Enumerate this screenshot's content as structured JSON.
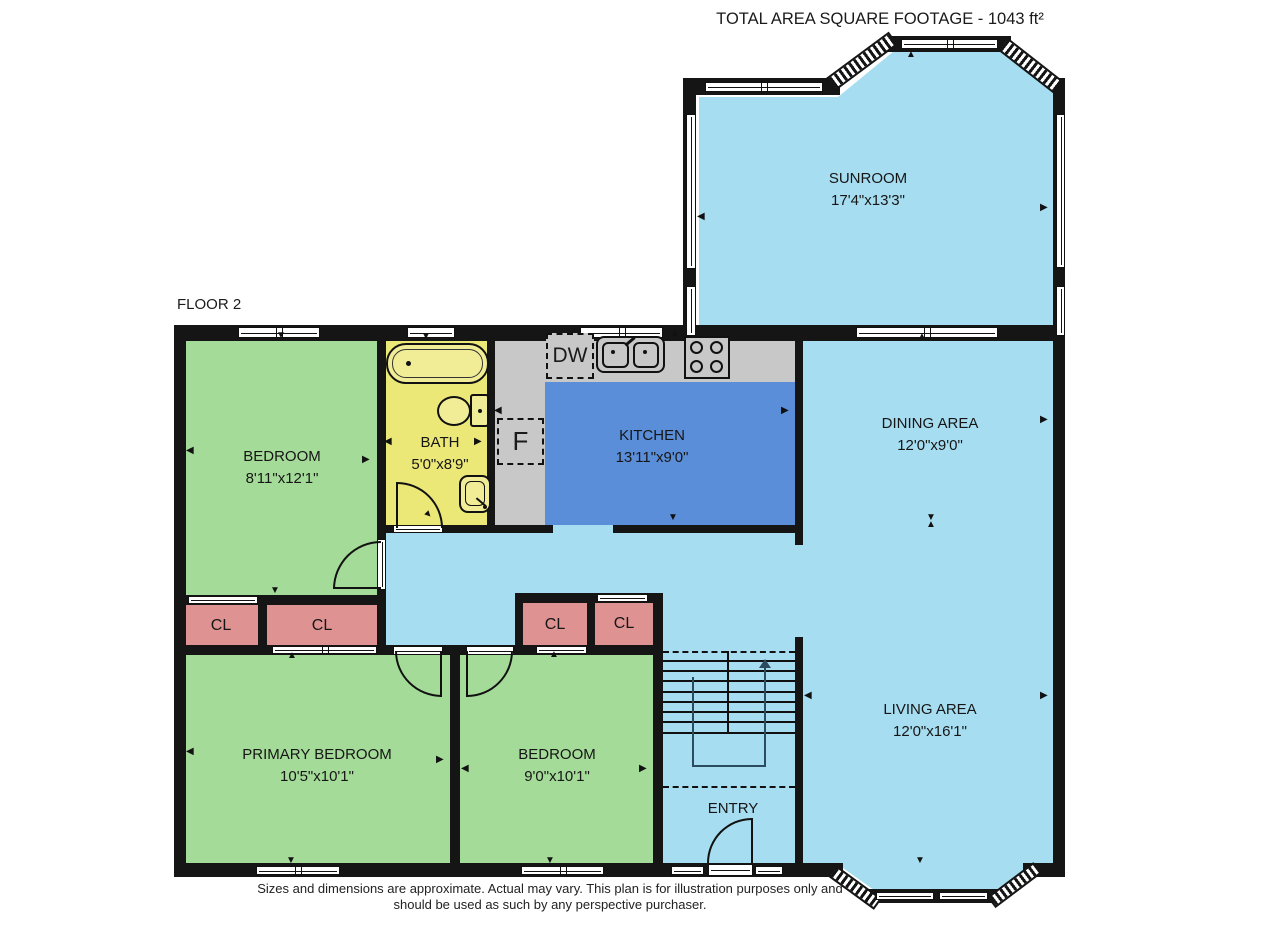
{
  "header": {
    "title": "TOTAL AREA SQUARE FOOTAGE - 1043 ft²"
  },
  "floor_label": "FLOOR 2",
  "rooms": {
    "sunroom": {
      "name": "SUNROOM",
      "dims": "17'4\"x13'3\""
    },
    "dining": {
      "name": "DINING AREA",
      "dims": "12'0\"x9'0\""
    },
    "living": {
      "name": "LIVING AREA",
      "dims": "12'0\"x16'1\""
    },
    "kitchen": {
      "name": "KITCHEN",
      "dims": "13'11\"x9'0\""
    },
    "bath": {
      "name": "BATH",
      "dims": "5'0\"x8'9\""
    },
    "bedroom1": {
      "name": "BEDROOM",
      "dims": "8'11\"x12'1\""
    },
    "primary": {
      "name": "PRIMARY BEDROOM",
      "dims": "10'5\"x10'1\""
    },
    "bedroom2": {
      "name": "BEDROOM",
      "dims": "9'0\"x10'1\""
    },
    "entry": {
      "name": "ENTRY"
    }
  },
  "closets": {
    "cl1": "CL",
    "cl2": "CL",
    "cl3": "CL",
    "cl4": "CL"
  },
  "appliances": {
    "dishwasher": "DW",
    "furnace": "F"
  },
  "footer": {
    "line1": "Sizes and dimensions are approximate. Actual may vary. This plan is for illustration purposes only and",
    "line2": "should be used as such by any perspective purchaser."
  },
  "colors": {
    "wall": "#151515",
    "floor_light_blue": "#a7ddf0",
    "kitchen_floor_blue": "#5b8ed8",
    "bedroom_green": "#a4db98",
    "closet_pink": "#df9292",
    "bath_yellow": "#ece878",
    "counter_gray": "#c8c8c8"
  }
}
